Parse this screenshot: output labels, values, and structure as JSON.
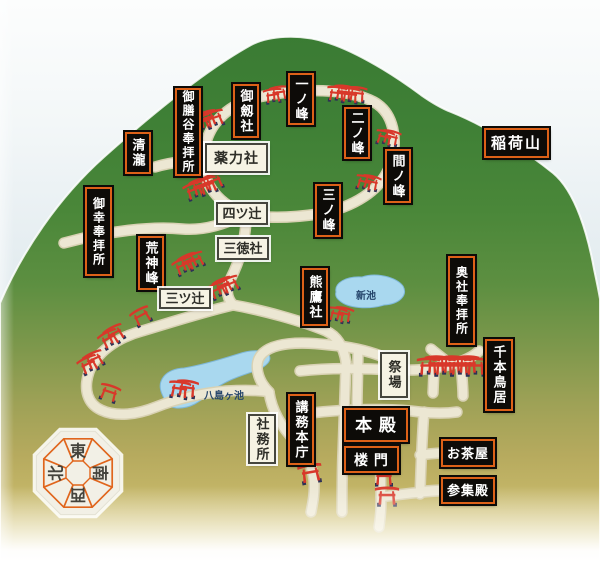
{
  "map": {
    "labels": [
      {
        "id": "gozendani-yohaisho",
        "text": "御膳谷奉拝所",
        "type": "bk-v",
        "x": 175,
        "y": 88,
        "w": 26,
        "h": 88,
        "fs": 12
      },
      {
        "id": "mitsurugisha",
        "text": "御劔社",
        "type": "bk-v",
        "x": 233,
        "y": 84,
        "w": 26,
        "h": 54,
        "fs": 13
      },
      {
        "id": "ichinomine",
        "text": "一ノ峰",
        "type": "bk-v",
        "x": 288,
        "y": 73,
        "w": 26,
        "h": 52,
        "fs": 13
      },
      {
        "id": "ninomine",
        "text": "二ノ峰",
        "type": "bk-v",
        "x": 344,
        "y": 107,
        "w": 26,
        "h": 52,
        "fs": 13
      },
      {
        "id": "ainomine",
        "text": "間ノ峰",
        "type": "bk-v",
        "x": 385,
        "y": 149,
        "w": 26,
        "h": 54,
        "fs": 13
      },
      {
        "id": "sannomine",
        "text": "三ノ峰",
        "type": "bk-v",
        "x": 315,
        "y": 184,
        "w": 26,
        "h": 53,
        "fs": 13
      },
      {
        "id": "kiyotaki",
        "text": "清瀧",
        "type": "bk-v",
        "x": 125,
        "y": 132,
        "w": 26,
        "h": 42,
        "fs": 13
      },
      {
        "id": "gokou-yohaisho",
        "text": "御幸奉拝所",
        "type": "bk-v",
        "x": 85,
        "y": 187,
        "w": 27,
        "h": 89,
        "fs": 12
      },
      {
        "id": "koujingamine",
        "text": "荒神峰",
        "type": "bk-v",
        "x": 138,
        "y": 236,
        "w": 26,
        "h": 54,
        "fs": 13
      },
      {
        "id": "kumatakasha",
        "text": "熊鷹社",
        "type": "bk-v",
        "x": 302,
        "y": 268,
        "w": 26,
        "h": 58,
        "fs": 13
      },
      {
        "id": "okusha-yohaisho",
        "text": "奥社奉拝所",
        "type": "bk-v",
        "x": 448,
        "y": 256,
        "w": 27,
        "h": 89,
        "fs": 12
      },
      {
        "id": "senbon-torii",
        "text": "千本鳥居",
        "type": "bk-v",
        "x": 485,
        "y": 339,
        "w": 28,
        "h": 72,
        "fs": 13
      },
      {
        "id": "koumu-honchou",
        "text": "講務本庁",
        "type": "bk-v",
        "x": 288,
        "y": 394,
        "w": 26,
        "h": 71,
        "fs": 13
      },
      {
        "id": "inariyama",
        "text": "稲荷山",
        "type": "bk-h",
        "x": 484,
        "y": 128,
        "w": 65,
        "h": 30,
        "fs": 15,
        "ls": 2
      },
      {
        "id": "honden",
        "text": "本 殿",
        "type": "bk-h",
        "x": 344,
        "y": 408,
        "w": 64,
        "h": 34,
        "fs": 17,
        "ls": 1
      },
      {
        "id": "roumon",
        "text": "楼 門",
        "type": "bk-h",
        "x": 344,
        "y": 446,
        "w": 55,
        "h": 27,
        "fs": 14,
        "ls": 1
      },
      {
        "id": "ochaya",
        "text": "お茶屋",
        "type": "bk-h",
        "x": 441,
        "y": 439,
        "w": 54,
        "h": 28,
        "fs": 13,
        "ls": 1
      },
      {
        "id": "sanshuuden",
        "text": "参集殿",
        "type": "bk-h",
        "x": 441,
        "y": 477,
        "w": 54,
        "h": 27,
        "fs": 13,
        "ls": 1
      },
      {
        "id": "yakurikisha",
        "text": "薬力社",
        "type": "wh-h",
        "x": 205,
        "y": 143,
        "w": 63,
        "h": 30,
        "fs": 14,
        "ls": 1
      },
      {
        "id": "yotsutsuji",
        "text": "四ツ辻",
        "type": "wh-h",
        "x": 216,
        "y": 202,
        "w": 52,
        "h": 23,
        "fs": 13
      },
      {
        "id": "santokusha",
        "text": "三徳社",
        "type": "wh-h",
        "x": 217,
        "y": 237,
        "w": 52,
        "h": 23,
        "fs": 13
      },
      {
        "id": "mitsutsuji",
        "text": "三ツ辻",
        "type": "wh-h",
        "x": 159,
        "y": 288,
        "w": 52,
        "h": 21,
        "fs": 13
      },
      {
        "id": "saijou",
        "text": "祭場",
        "type": "wh-v",
        "x": 380,
        "y": 352,
        "w": 28,
        "h": 46,
        "fs": 13
      },
      {
        "id": "shamusho",
        "text": "社務所",
        "type": "wh-v",
        "x": 248,
        "y": 414,
        "w": 28,
        "h": 50,
        "fs": 13
      }
    ],
    "ponds": {
      "shinike": {
        "name": "新池"
      },
      "yashima": {
        "name": "八島ヶ池"
      }
    },
    "compass": {
      "east": "東",
      "south": "南",
      "west": "西",
      "north": "北"
    },
    "torii_clusters": [
      {
        "x": 210,
        "y": 128,
        "rot": -18,
        "n": 3,
        "s": 0.95
      },
      {
        "x": 277,
        "y": 102,
        "rot": -8,
        "n": 2,
        "s": 0.85
      },
      {
        "x": 346,
        "y": 102,
        "rot": 6,
        "n": 4,
        "s": 0.9
      },
      {
        "x": 386,
        "y": 145,
        "rot": 14,
        "n": 2,
        "s": 0.85
      },
      {
        "x": 366,
        "y": 190,
        "rot": 14,
        "n": 2,
        "s": 0.85
      },
      {
        "x": 207,
        "y": 194,
        "rot": -20,
        "n": 4,
        "s": 0.95
      },
      {
        "x": 192,
        "y": 270,
        "rot": -24,
        "n": 3,
        "s": 0.9
      },
      {
        "x": 227,
        "y": 294,
        "rot": -24,
        "n": 3,
        "s": 0.9
      },
      {
        "x": 145,
        "y": 323,
        "rot": -28,
        "n": 1,
        "s": 0.95
      },
      {
        "x": 116,
        "y": 344,
        "rot": -28,
        "n": 2,
        "s": 0.95
      },
      {
        "x": 95,
        "y": 370,
        "rot": -25,
        "n": 2,
        "s": 0.95
      },
      {
        "x": 107,
        "y": 400,
        "rot": 18,
        "n": 1,
        "s": 0.95
      },
      {
        "x": 182,
        "y": 398,
        "rot": 8,
        "n": 2,
        "s": 1.0
      },
      {
        "x": 339,
        "y": 322,
        "rot": 12,
        "n": 2,
        "s": 0.85
      },
      {
        "x": 452,
        "y": 375,
        "rot": 0,
        "n": 7,
        "s": 1.05
      },
      {
        "x": 312,
        "y": 482,
        "rot": -10,
        "n": 1,
        "s": 1.1
      },
      {
        "x": 384,
        "y": 485,
        "rot": 0,
        "n": 1,
        "s": 1.0
      },
      {
        "x": 387,
        "y": 505,
        "rot": 0,
        "n": 1,
        "s": 1.1
      }
    ],
    "colors": {
      "torii_red": "#d8382a",
      "torii_foot_navy": "#2d3156",
      "label_border_orange": "#dd6118",
      "black_label_bg": "#0d0b08",
      "white_label_bg": "#f6f3e4",
      "path_cream": "#ebe6d2",
      "pond_blue": "#a9d8ef",
      "mountain_green": "#3a7b33",
      "lowland_gold": "#c9ba6b",
      "compass_orange": "#e0651c"
    }
  }
}
